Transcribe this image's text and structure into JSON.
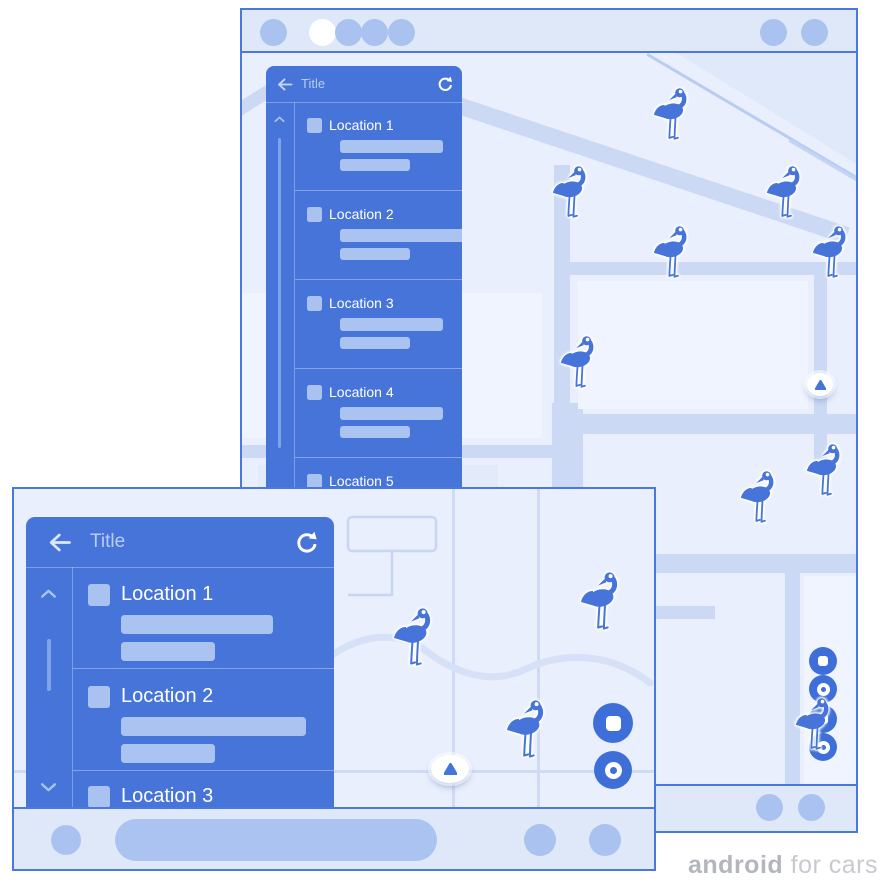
{
  "colors": {
    "primary_blue": "#4674d9",
    "accent_light_blue": "#aac3f0",
    "system_bar_bg": "#dfe8f8",
    "map_bg": "#e9effc",
    "map_road": "#ccd9f4",
    "frame_border": "#4a79dd",
    "fab_blue": "#3e6fd8",
    "title_text": "#b9ccf4",
    "item_text": "#ffffff",
    "watermark_bold": "#b3b6bc",
    "watermark_light": "#c7cacf"
  },
  "portrait_app": {
    "title": "Title",
    "items": [
      "Location 1",
      "Location 2",
      "Location 3",
      "Location 4",
      "Location 5"
    ]
  },
  "landscape_app": {
    "title": "Title",
    "items": [
      "Location 1",
      "Location 2",
      "Location 3"
    ]
  },
  "icons": {
    "back": "back-arrow",
    "refresh": "refresh-circular-arrow",
    "scroll_up": "chevron-up",
    "scroll_down": "chevron-down",
    "map_marker": "flamingo",
    "compass": "navigation-triangle",
    "fab_top": "square-in-circle",
    "fab_bottom": "ring-in-circle"
  },
  "watermark": {
    "brand": "android",
    "suffix": " for cars"
  }
}
